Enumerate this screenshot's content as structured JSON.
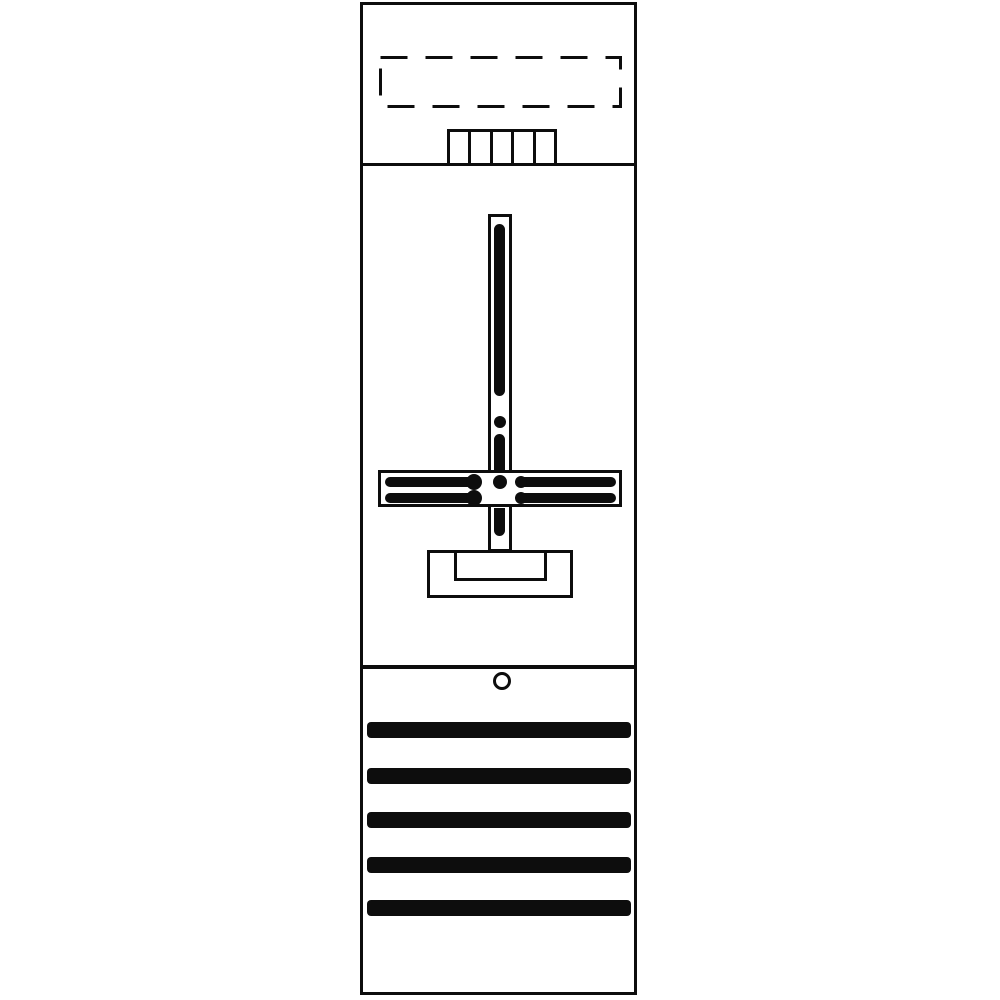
{
  "drawing": {
    "description": "technical line drawing of a single-field meter panel (front view)",
    "background_color": "#ffffff",
    "line_color": "#0d0d0d",
    "canvas": {
      "width": 1000,
      "height": 1000
    }
  },
  "panel": {
    "x": 360,
    "y": 2,
    "width": 277,
    "height": 993,
    "stroke_width": 3
  },
  "dividers": [
    {
      "name": "top-section-divider",
      "x": 360,
      "y": 163,
      "width": 277,
      "height": 3
    },
    {
      "name": "bottom-section-divider",
      "x": 360,
      "y": 665,
      "width": 277,
      "height": 4
    }
  ],
  "dashed_area": {
    "x": 379,
    "y": 56,
    "width": 243,
    "height": 52,
    "stroke_width": 3,
    "dash_pattern": "27 18"
  },
  "terminal_block": {
    "x": 447,
    "y": 129,
    "width": 110,
    "height": 37,
    "cells": 5,
    "stroke_width": 3
  },
  "rail": {
    "x": 488,
    "y": 214,
    "width": 24,
    "height": 338,
    "stroke_width": 3,
    "segments": [
      {
        "x": 494,
        "y": 224,
        "width": 11,
        "height": 172,
        "radius": "6px"
      },
      {
        "x": 494,
        "y": 434,
        "width": 11,
        "height": 36,
        "radius": "6px 6px 0 0"
      },
      {
        "x": 494,
        "y": 508,
        "width": 11,
        "height": 28,
        "radius": "0 0 6px 6px"
      }
    ],
    "dots": [
      {
        "cx": 500,
        "cy": 422,
        "r": 6
      }
    ]
  },
  "crossbar": {
    "x": 378,
    "y": 470,
    "width": 244,
    "height": 37,
    "stroke_width": 3,
    "stripes": [
      {
        "x": 385,
        "y": 477,
        "width": 96,
        "height": 10
      },
      {
        "x": 385,
        "y": 493,
        "width": 96,
        "height": 10
      },
      {
        "x": 519,
        "y": 477,
        "width": 97,
        "height": 10
      },
      {
        "x": 519,
        "y": 493,
        "width": 97,
        "height": 10
      }
    ],
    "bulges": [
      {
        "cx": 474,
        "cy": 482,
        "r": 8
      },
      {
        "cx": 474,
        "cy": 498,
        "r": 8
      },
      {
        "cx": 521,
        "cy": 482,
        "r": 6
      },
      {
        "cx": 521,
        "cy": 498,
        "r": 6
      }
    ],
    "center_dot": {
      "cx": 500,
      "cy": 482,
      "r": 7
    }
  },
  "bracket": {
    "outer": {
      "x": 427,
      "y": 550,
      "width": 146,
      "height": 48,
      "stroke_width": 3
    },
    "inner": {
      "x": 454,
      "y": 550,
      "width": 93,
      "height": 31,
      "stroke_width": 3
    }
  },
  "screw_hole": {
    "cx": 502,
    "cy": 681,
    "r": 9,
    "stroke_width": 3
  },
  "cover_strips": {
    "x": 367,
    "width": 264,
    "height": 16,
    "radius": 4,
    "tops": [
      722,
      768,
      812,
      857,
      900
    ]
  }
}
